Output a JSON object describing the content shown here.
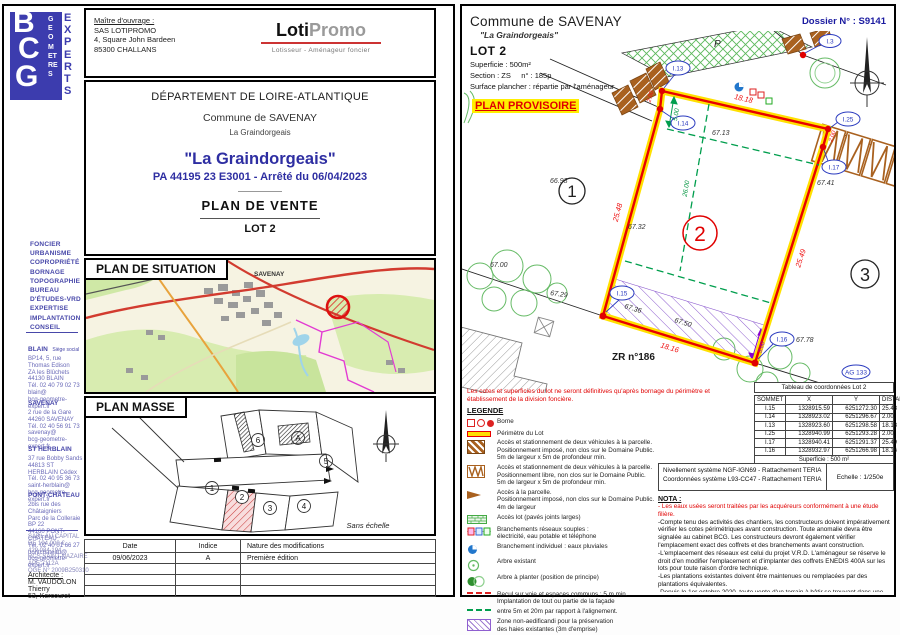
{
  "left": {
    "logo": {
      "b": "B",
      "c": "C",
      "g": "G",
      "geometres": "GEOMETRES",
      "experts": "EXPERTS"
    },
    "services": "FONCIER\nURBANISME\nCOPROPRIÉTÉ\nBORNAGE\nTOPOGRAPHIE\nBUREAU\n D'ÉTUDES-VRD\nEXPERTISE\nIMPLANTATION\nCONSEIL",
    "offices": [
      {
        "name": "BLAIN",
        "tag": "Siège social",
        "addr": "BP14, 5, rue Thomas Edison\nZA les Blûchets 44130 BLAIN\nTél. 02 40 79 02 73\nblain@\nbcg-geometre-expert.fr"
      },
      {
        "name": "SAVENAY",
        "tag": "",
        "addr": "2 rue de la Gare\n44260 SAVENAY\nTél. 02 40 56 91 73\nsavenay@\nbcg-geometre-expert.fr"
      },
      {
        "name": "ST HERBLAIN",
        "tag": "",
        "addr": "37 rue Bobby Sands\n44813 ST HERBLAIN Cédex\nTél. 02 40 95 36 73\nsaint-herblain@\nbcg-geometre-expert.fr"
      },
      {
        "name": "PONT-CHÂTEAU",
        "tag": "",
        "addr": "2bis rue des Châtaigniers\nParc de la Colleraie BP 22\n44160 PONT-CHÂTEAU\nTél. 02 40 01 66 27\npontchateau@\nbcg-geometre-expert.fr"
      }
    ],
    "legal": "SARL AU CAPITAL\nDE 194 000 €\n429 034 194\nRCS SAINT-NAZAIRE\nAPE 7112A\nOGE N° 2009B250310",
    "architect": {
      "label": "Architecte :",
      "name": "M. VAUDOLON Thierry",
      "line2": "53, Kercouret"
    },
    "owner": {
      "label": "Maître d'ouvrage :",
      "name": "SAS LOTIPROMO",
      "addr1": "4, Square John Bardeen",
      "addr2": "85300 CHALLANS"
    },
    "brand": {
      "loti": "Loti",
      "promo": "Promo",
      "subtitle": "Lotisseur - Aménageur foncier"
    },
    "title": {
      "dept": "DÉPARTEMENT DE LOIRE-ATLANTIQUE",
      "commune": "Commune de SAVENAY",
      "place": "La Graindorgeais",
      "project": "\"La Graindorgeais\"",
      "permit": "PA 44195 23 E3001 - Arrêté du 06/04/2023",
      "doc": "PLAN  DE  VENTE",
      "lot": "LOT 2"
    },
    "situation": {
      "title": "PLAN  DE  SITUATION",
      "city": "SAVENAY"
    },
    "masse": {
      "title": "PLAN  MASSE",
      "scale": "Sans échelle",
      "lots": {
        "l1": "1",
        "l2": "2",
        "l3": "3",
        "l4": "4",
        "l5": "5",
        "l6": "6",
        "la": "A"
      }
    },
    "revisions": {
      "h_date": "Date",
      "h_indice": "Indice",
      "h_nature": "Nature des modifications",
      "row1": {
        "date": "09/06/2023",
        "indice": "A",
        "nature": "Première édition"
      }
    }
  },
  "right": {
    "header": {
      "commune": "Commune de SAVENAY",
      "place": "\"La Graindorgeais\"",
      "dossier": "Dossier N° : S9141"
    },
    "lot": {
      "name": "LOT 2",
      "superficie": "Superficie :  500m²",
      "section": "Section : ZS     n° : 185p",
      "plancher": "Surface plancher : répartie par l'aménageur",
      "provisoire": "PLAN PROVISOIRE"
    },
    "plan": {
      "labels": {
        "p": "P",
        "zr": "ZR n°186",
        "lot1": "1",
        "lot2": "2",
        "lot3": "3",
        "i3": "I.3",
        "i13": "I.13",
        "i14": "I.14",
        "i25": "I.25",
        "i17": "I.17",
        "i15": "I.15",
        "i16": "I.16",
        "ag": "AG 133"
      },
      "dims_red": {
        "top": "18.18",
        "left": "25.48",
        "right": "25.49",
        "bottom": "18.16",
        "c200a": "2.00",
        "c200b": "2.00"
      },
      "dims_black": {
        "d6693": "66.93",
        "d6713": "67.13",
        "d6732": "67.32",
        "d6741": "67.41",
        "d6700": "67.00",
        "d6729": "67.29",
        "d6736": "67.36",
        "d6750": "67.50",
        "d6778": "67.78"
      },
      "dims_green": {
        "g500": "5.00",
        "g2600": "26.00"
      },
      "dims_purple": {
        "p300": "3.00"
      }
    },
    "disclaimer": "Les cotes et superficies du lot ne seront définitives qu'après bornage du périmètre et\nétablissement de la division foncière.",
    "legend": {
      "title": "LEGENDE",
      "items": [
        "Borne",
        "Périmètre du Lot",
        "Accès et stationnement de deux véhicules à la parcelle.\nPositionnement imposé, non clos sur le Domaine Public.\n5m de largeur x 5m de profondeur min.",
        "Accès et stationnement de deux véhicules à la parcelle.\nPositionnement libre, non clos sur le Domaine Public.\n5m de largeur x 5m de profondeur min.",
        "Accès à la parcelle.\nPositionnement imposé, non clos sur le Domaine Public.\n4m de largeur",
        "Accès lot (pavés joints larges)",
        "Branchements réseaux souples :\nélectricité, eau potable et téléphone",
        "Branchement individuel : eaux pluviales",
        "Arbre existant",
        "Arbre à planter (position de principe)",
        "Recul sur voie et espaces communs : 5 m min.\nImplantation de tout ou partie de la façade",
        "entre 5m et 20m par rapport à l'alignement.",
        "Zone non-aedificandi pour la préservation\ndes haies existantes (3m d'emprise)"
      ]
    },
    "coords": {
      "title": "Tableau de coordonnées Lot 2",
      "h": [
        "SOMMET",
        "X",
        "Y",
        "DISTANCE"
      ],
      "rows": [
        [
          "I.15",
          "1328915.59",
          "6251272.30",
          "25.48"
        ],
        [
          "I.14",
          "1328923.02",
          "6251296.67",
          "2.00"
        ],
        [
          "I.13",
          "1328923.60",
          "6251298.58",
          "18.18"
        ],
        [
          "I.25",
          "1328940.99",
          "6251293.28",
          "2.00"
        ],
        [
          "I.17",
          "1328940.41",
          "6251291.37",
          "25.49"
        ],
        [
          "I.16",
          "1328932.97",
          "6251266.98",
          "18.16"
        ]
      ],
      "footer": "Superficie : 500 m²"
    },
    "geo": {
      "line1": "Nivellement système NGF-IGN69 - Rattachement TERIA",
      "line2": "Coordonnées système L93-CC47  - Rattachement TERIA",
      "scale": "Echelle : 1/250e"
    },
    "nota": {
      "title": "NOTA :",
      "red": "- Les eaux usées seront traitées par les acquéreurs conformément à une étude filière.",
      "p1": "-Compte tenu des activités des chantiers, les constructeurs doivent impérativement vérifier les cotes périmétriques avant construction. Toute anomalie devra être signalée au cabinet BCG. Les constructeurs devront également vérifier l'emplacement exact des coffrets et des branchements avant construction.",
      "p2": "-L'emplacement des réseaux est celui du projet V.R.D. L'aménageur se réserve le droit d'en modifier l'emplacement et d'implanter des coffrets ENEDIS 400A sur les lots pour toute raison d'ordre technique.",
      "p3": "-Les plantations existantes doivent être maintenues ou remplacées par des plantations équivalentes.",
      "p4": "-Depuis le 1er octobre 2020, toute vente d'un terrain à bâtir se trouvant dans une zone à"
    }
  }
}
